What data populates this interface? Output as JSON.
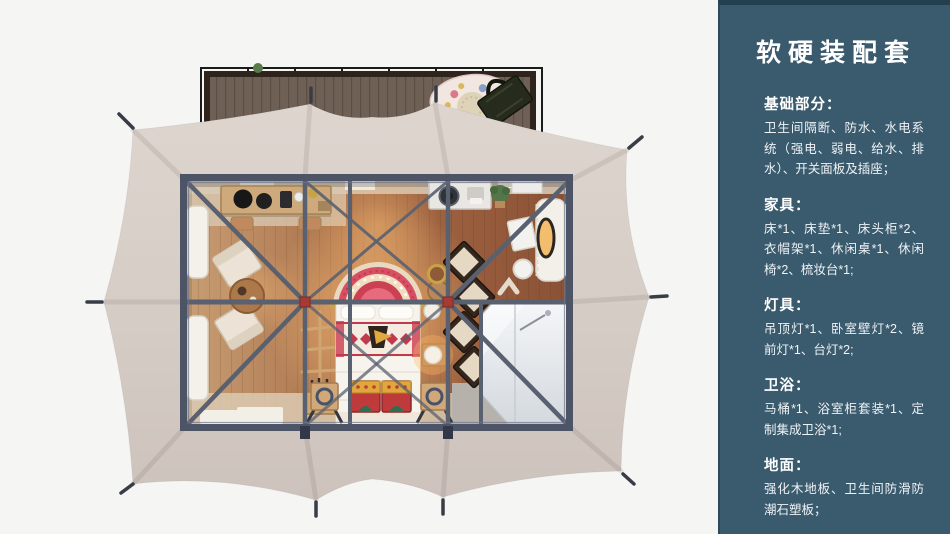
{
  "panel": {
    "title": "软硬装配套",
    "sections": [
      {
        "heading": "基础部分：",
        "body": "卫生间隔断、防水、水电系统（强电、弱电、给水、排水）、开关面板及插座；"
      },
      {
        "heading": "家具：",
        "body": "床*1、床垫*1、床头柜*2、衣帽架*1、休闲桌*1、休闲椅*2、梳妆台*1;"
      },
      {
        "heading": "灯具：",
        "body": "吊顶灯*1、卧室壁灯*2、镜前灯*1、台灯*2;"
      },
      {
        "heading": "卫浴：",
        "body": "马桶*1、浴室柜套装*1、定制集成卫浴*1;"
      },
      {
        "heading": "地面：",
        "body": "强化木地板、卫生间防滑防潮石塑板；"
      }
    ]
  },
  "colors": {
    "sidebar_bg": "#3a5a6d",
    "sidebar_top_edge": "#24404e",
    "canvas_bg": "#f5f5f4",
    "tent_canopy": "#d6ccc6",
    "steel_frame": "#59606f",
    "frame_hub_red": "#a83a34",
    "wood_floor": "#aa714a",
    "deck_wood": "#6e6055"
  }
}
